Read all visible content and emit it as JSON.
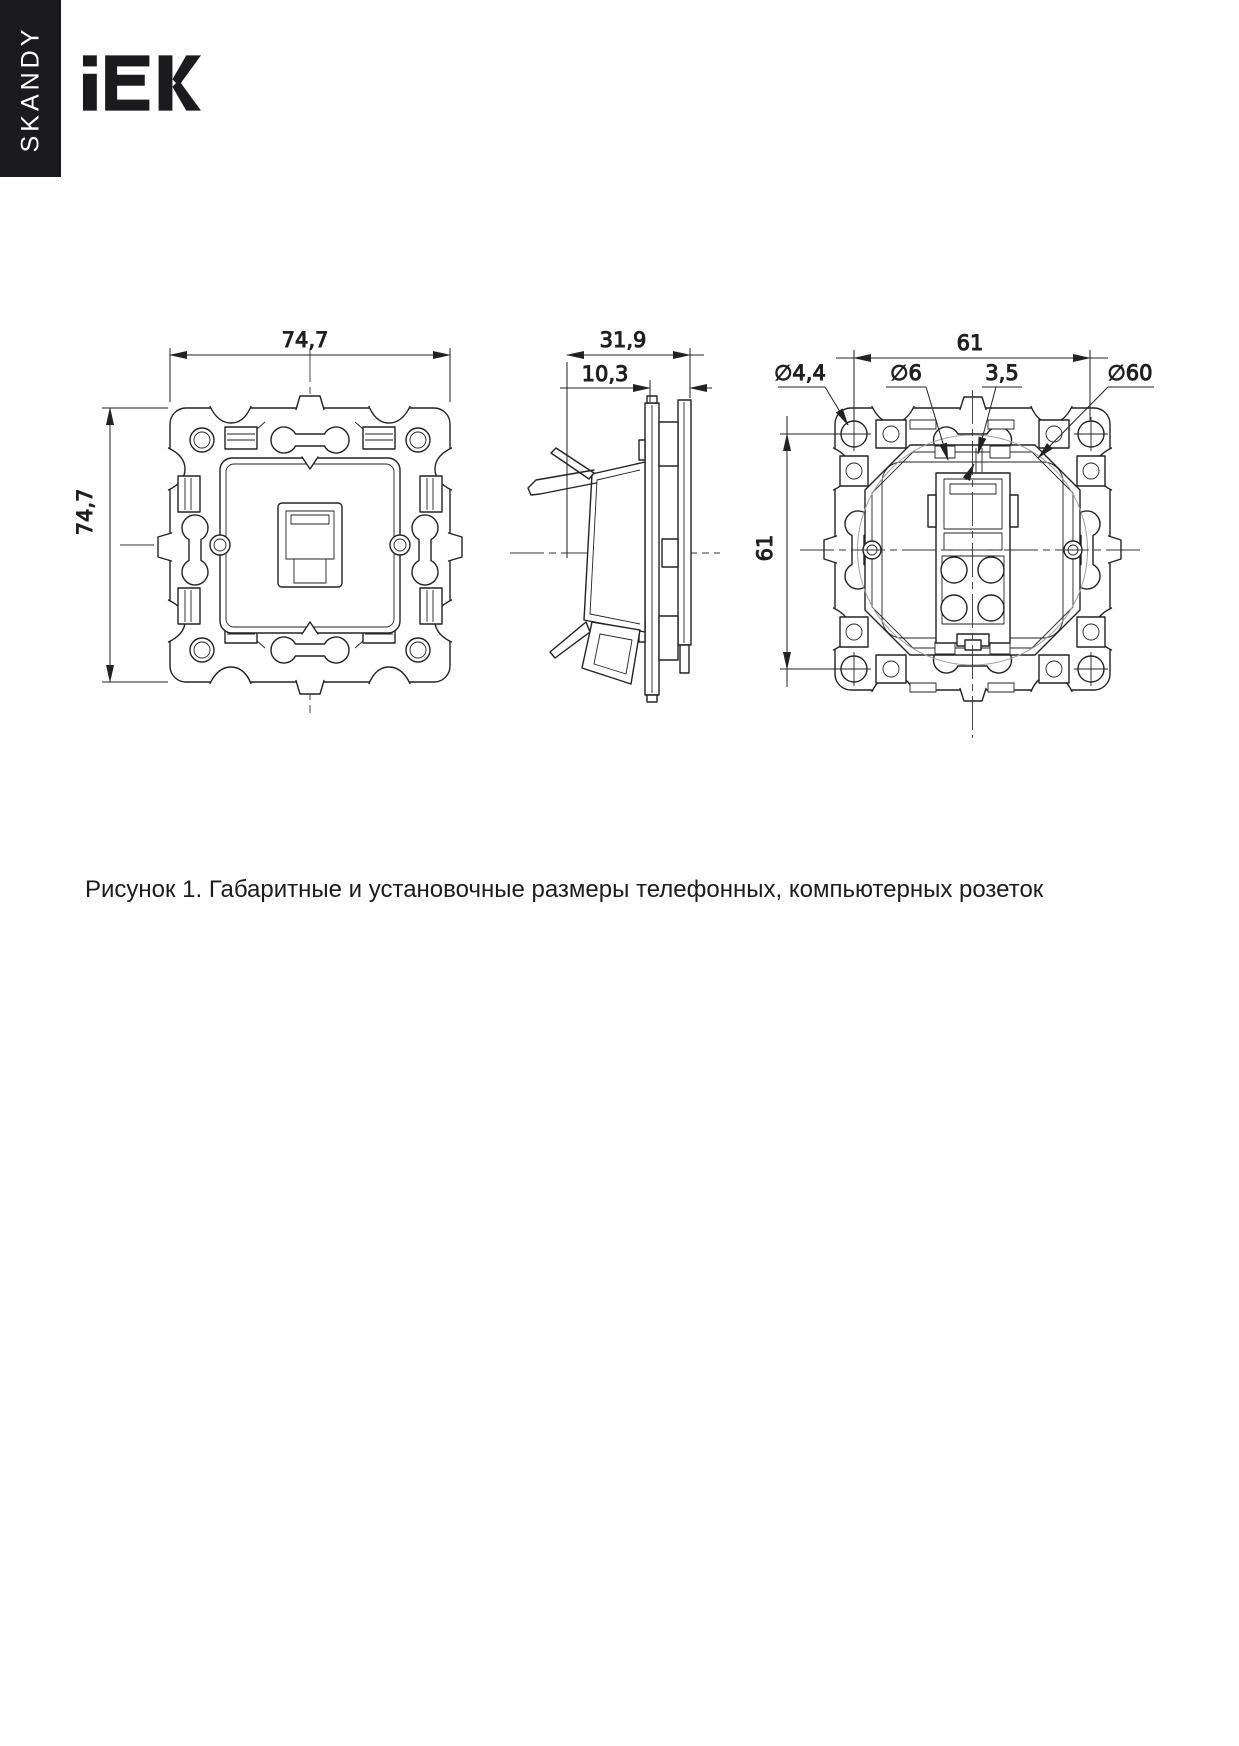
{
  "brand": {
    "series": "SKANDY",
    "logo": "IEK"
  },
  "figure": {
    "caption": "Рисунок 1. Габаритные и установочные размеры телефонных, компьютерных розеток"
  },
  "dims": {
    "front": {
      "width": "74,7",
      "height": "74,7"
    },
    "side": {
      "depth": "31,9",
      "protrusion": "10,3"
    },
    "back": {
      "span_h": "61",
      "span_v": "61",
      "screw_hole": "∅4,4",
      "slot_hole": "∅6",
      "slot_width": "3,5",
      "mount_dia": "∅60"
    }
  }
}
